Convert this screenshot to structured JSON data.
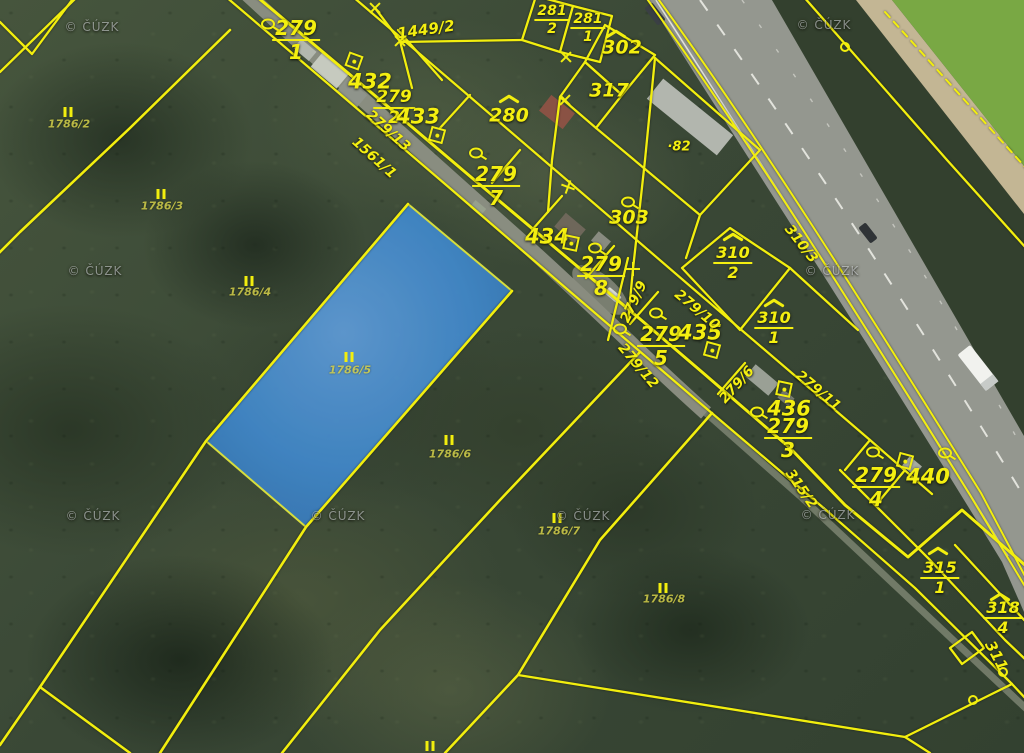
{
  "map": {
    "provider_watermark": "© ČÚZK",
    "highlighted_parcel": "1786/5",
    "accent_colors": {
      "cadastral_line": "#f2ee0e",
      "label": "#f4ef10",
      "highlight_fill": "#4189cc"
    },
    "labels": [
      {
        "text": "279/1",
        "kind": "stacked",
        "x": 296,
        "y": 40
      },
      {
        "text": "279/2",
        "kind": "stacked",
        "x": 394,
        "y": 108,
        "size": 17
      },
      {
        "text": "279/7",
        "kind": "stacked",
        "x": 496,
        "y": 186
      },
      {
        "text": "279/8",
        "kind": "stacked",
        "x": 601,
        "y": 276
      },
      {
        "text": "279/5",
        "kind": "stacked",
        "x": 661,
        "y": 346
      },
      {
        "text": "279/3",
        "kind": "stacked",
        "x": 788,
        "y": 438
      },
      {
        "text": "279/4",
        "kind": "stacked",
        "x": 876,
        "y": 487
      },
      {
        "text": "281/2",
        "kind": "stacked",
        "x": 552,
        "y": 20,
        "size": 14
      },
      {
        "text": "281/1",
        "kind": "stacked",
        "x": 588,
        "y": 28,
        "size": 14
      },
      {
        "text": "310/2",
        "kind": "stacked",
        "x": 733,
        "y": 263,
        "size": 16
      },
      {
        "text": "310/1",
        "kind": "stacked",
        "x": 774,
        "y": 328,
        "size": 16
      },
      {
        "text": "315/1",
        "kind": "stacked",
        "x": 940,
        "y": 578,
        "size": 16
      },
      {
        "text": "318/4",
        "kind": "stacked",
        "x": 1003,
        "y": 618,
        "size": 16
      },
      {
        "text": "432",
        "kind": "plain",
        "x": 370,
        "y": 82
      },
      {
        "text": "433",
        "kind": "plain",
        "x": 418,
        "y": 117
      },
      {
        "text": "434",
        "kind": "plain",
        "x": 547,
        "y": 237
      },
      {
        "text": "435",
        "kind": "plain",
        "x": 700,
        "y": 333
      },
      {
        "text": "436",
        "kind": "plain",
        "x": 789,
        "y": 409
      },
      {
        "text": "440",
        "kind": "plain",
        "x": 928,
        "y": 477
      },
      {
        "text": "280",
        "kind": "plain",
        "x": 509,
        "y": 116,
        "size": 19
      },
      {
        "text": "302",
        "kind": "plain",
        "x": 622,
        "y": 48,
        "size": 19
      },
      {
        "text": "317",
        "kind": "plain",
        "x": 609,
        "y": 91,
        "size": 19
      },
      {
        "text": "303",
        "kind": "plain",
        "x": 629,
        "y": 218,
        "size": 19
      },
      {
        "text": "1449/2",
        "kind": "plain",
        "x": 426,
        "y": 30,
        "size": 15,
        "rot": -8
      },
      {
        "text": "·82",
        "kind": "plain",
        "x": 679,
        "y": 147,
        "size": 13
      },
      {
        "text": "279/13",
        "kind": "rot",
        "x": 388,
        "y": 131,
        "rot": 42
      },
      {
        "text": "1561/1",
        "kind": "rot",
        "x": 374,
        "y": 158,
        "rot": 42
      },
      {
        "text": "279/9",
        "kind": "rot",
        "x": 634,
        "y": 302,
        "rot": -65
      },
      {
        "text": "279/10",
        "kind": "rot",
        "x": 697,
        "y": 310,
        "rot": 40
      },
      {
        "text": "279/12",
        "kind": "rot",
        "x": 638,
        "y": 366,
        "rot": 50
      },
      {
        "text": "279/6",
        "kind": "rot",
        "x": 737,
        "y": 385,
        "rot": -48
      },
      {
        "text": "279/11",
        "kind": "rot",
        "x": 818,
        "y": 391,
        "rot": 40
      },
      {
        "text": "315/2",
        "kind": "rot",
        "x": 801,
        "y": 489,
        "rot": 55
      },
      {
        "text": "311",
        "kind": "rot",
        "x": 996,
        "y": 656,
        "rot": 62,
        "size": 15
      },
      {
        "text": "310/3",
        "kind": "rot",
        "x": 801,
        "y": 244,
        "rot": 52
      },
      {
        "text": "1786/2",
        "kind": "dim",
        "x": 69,
        "y": 124
      },
      {
        "text": "1786/3",
        "kind": "dim",
        "x": 162,
        "y": 206
      },
      {
        "text": "1786/4",
        "kind": "dim",
        "x": 250,
        "y": 292
      },
      {
        "text": "1786/5",
        "kind": "dim",
        "x": 350,
        "y": 370
      },
      {
        "text": "1786/6",
        "kind": "dim",
        "x": 450,
        "y": 454
      },
      {
        "text": "1786/7",
        "kind": "dim",
        "x": 559,
        "y": 531
      },
      {
        "text": "1786/8",
        "kind": "dim",
        "x": 664,
        "y": 599
      }
    ],
    "symbols": [
      {
        "type": "forest-ii",
        "x": 68,
        "y": 112
      },
      {
        "type": "forest-ii",
        "x": 161,
        "y": 194
      },
      {
        "type": "forest-ii",
        "x": 249,
        "y": 281
      },
      {
        "type": "forest-ii",
        "x": 349,
        "y": 357
      },
      {
        "type": "forest-ii",
        "x": 449,
        "y": 440
      },
      {
        "type": "forest-ii",
        "x": 557,
        "y": 518
      },
      {
        "type": "forest-ii",
        "x": 663,
        "y": 588
      },
      {
        "type": "forest-ii",
        "x": 430,
        "y": 746
      },
      {
        "type": "garden-circle",
        "x": 268,
        "y": 24
      },
      {
        "type": "garden-circle",
        "x": 476,
        "y": 153
      },
      {
        "type": "garden-circle",
        "x": 595,
        "y": 248
      },
      {
        "type": "garden-circle",
        "x": 628,
        "y": 202
      },
      {
        "type": "garden-circle",
        "x": 620,
        "y": 329
      },
      {
        "type": "garden-circle",
        "x": 656,
        "y": 313
      },
      {
        "type": "garden-circle",
        "x": 757,
        "y": 412
      },
      {
        "type": "garden-circle",
        "x": 873,
        "y": 452
      },
      {
        "type": "garden-circle",
        "x": 945,
        "y": 453
      },
      {
        "type": "building-square",
        "x": 354,
        "y": 61,
        "rot": 20
      },
      {
        "type": "building-square",
        "x": 437,
        "y": 135,
        "rot": 15
      },
      {
        "type": "building-square",
        "x": 571,
        "y": 243,
        "rot": 12
      },
      {
        "type": "building-square",
        "x": 712,
        "y": 350,
        "rot": 15
      },
      {
        "type": "building-square",
        "x": 784,
        "y": 389,
        "rot": 12
      },
      {
        "type": "building-square",
        "x": 905,
        "y": 461,
        "rot": 15
      },
      {
        "type": "caret",
        "x": 509,
        "y": 99
      },
      {
        "type": "caret",
        "x": 616,
        "y": 34
      },
      {
        "type": "caret",
        "x": 733,
        "y": 237
      },
      {
        "type": "caret",
        "x": 774,
        "y": 303
      },
      {
        "type": "caret",
        "x": 938,
        "y": 551
      },
      {
        "type": "caret",
        "x": 1000,
        "y": 597
      },
      {
        "type": "cross-plus",
        "x": 633,
        "y": 269
      },
      {
        "type": "cross-x",
        "x": 375,
        "y": 8,
        "rot": 45
      },
      {
        "type": "cross-x",
        "x": 400,
        "y": 41,
        "rot": 45
      },
      {
        "type": "cross-x",
        "x": 566,
        "y": 57,
        "rot": 45
      },
      {
        "type": "cross-x",
        "x": 565,
        "y": 100,
        "rot": 45
      },
      {
        "type": "cross-x",
        "x": 568,
        "y": 187,
        "rot": 20
      },
      {
        "type": "ring",
        "x": 845,
        "y": 47
      },
      {
        "type": "ring",
        "x": 1003,
        "y": 672
      },
      {
        "type": "ring",
        "x": 973,
        "y": 700
      }
    ],
    "watermarks": [
      {
        "x": 92,
        "y": 27
      },
      {
        "x": 824,
        "y": 25
      },
      {
        "x": 95,
        "y": 271
      },
      {
        "x": 832,
        "y": 271
      },
      {
        "x": 93,
        "y": 516
      },
      {
        "x": 338,
        "y": 516
      },
      {
        "x": 583,
        "y": 516
      },
      {
        "x": 828,
        "y": 515
      }
    ]
  }
}
